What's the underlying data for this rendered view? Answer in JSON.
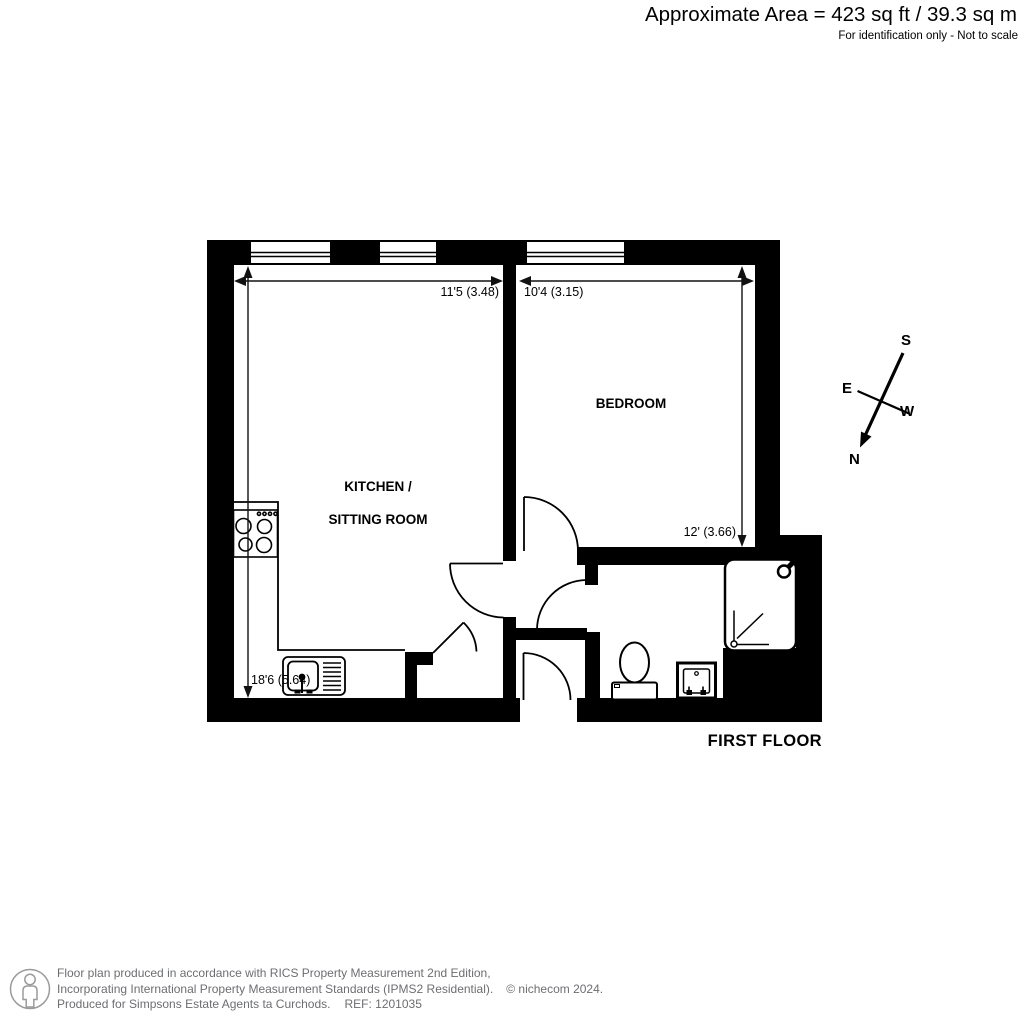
{
  "header": {
    "area": "Approximate Area = 423 sq ft / 39.3 sq m",
    "note": "For identification only - Not to scale"
  },
  "plan": {
    "floor_label": "FIRST FLOOR",
    "rooms": {
      "kitchen_line1": "KITCHEN /",
      "kitchen_line2": "SITTING ROOM",
      "bedroom": "BEDROOM"
    },
    "dimensions": {
      "kitchen_width": "11'5 (3.48)",
      "kitchen_depth": "18'6 (5.64)",
      "bedroom_width": "10'4 (3.15)",
      "bedroom_depth": "12' (3.66)"
    },
    "compass": {
      "north": "N",
      "south": "S",
      "east": "E",
      "west": "W"
    },
    "icons": [
      "window-icon",
      "door-arc-icon",
      "hob-icon",
      "kitchen-sink-icon",
      "toilet-icon",
      "basin-icon",
      "shower-icon",
      "compass-icon",
      "dimension-arrow-icon",
      "person-logo-icon"
    ]
  },
  "footer": {
    "line1": "Floor plan produced in accordance with RICS Property Measurement 2nd Edition,",
    "line2": "Incorporating International Property Measurement Standards (IPMS2 Residential).",
    "copyright": "© nichecom 2024.",
    "line3": "Produced for Simpsons Estate Agents ta Curchods.",
    "ref": "REF: 1201035"
  }
}
